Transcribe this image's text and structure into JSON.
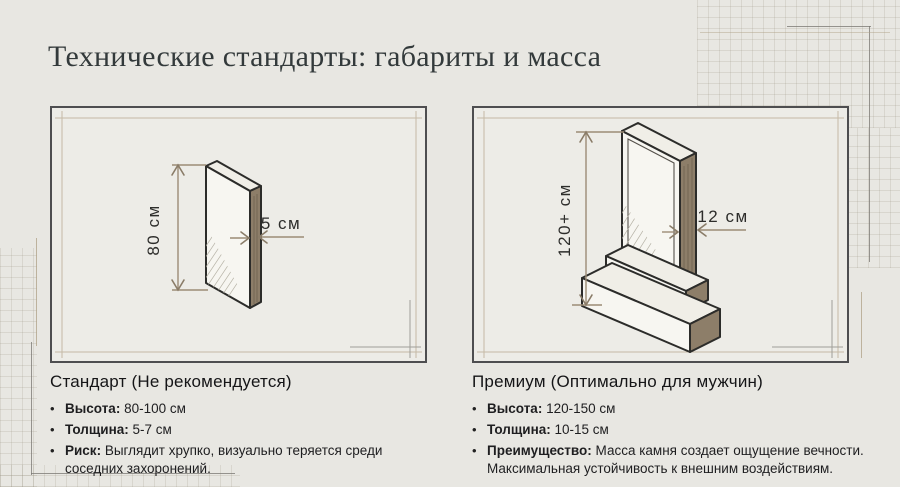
{
  "title": "Технические стандарты: габариты и масса",
  "bullet_icon": "•",
  "panels": [
    {
      "id": "standard",
      "heading": "Стандарт (Не рекомендуется)",
      "dimensions": {
        "height_label": "80 см",
        "thickness_label": "5 см"
      },
      "bullets": [
        {
          "label": "Высота:",
          "text": "80-100 см"
        },
        {
          "label": "Толщина:",
          "text": "5-7 см"
        },
        {
          "label": "Риск:",
          "text": "Выглядит хрупко, визуально теряется среди соседних захоронений."
        }
      ]
    },
    {
      "id": "premium",
      "heading": "Премиум (Оптимально для мужчин)",
      "dimensions": {
        "height_label": "120+ см",
        "thickness_label": "12 см"
      },
      "bullets": [
        {
          "label": "Высота:",
          "text": "120-150 см"
        },
        {
          "label": "Толщина:",
          "text": "10-15 см"
        },
        {
          "label": "Преимущество:",
          "text": "Масса камня создает ощущение вечности. Максимальная устойчивость к внешним воздействиям."
        }
      ]
    }
  ],
  "colors": {
    "background": "#e8e7e2",
    "panel_background": "#edece7",
    "panel_border": "#4e4e50",
    "stone_outline": "#2c2c2a",
    "stone_side": "#8d7e69",
    "dimension_line": "#9c8c76",
    "title_text": "#333a3b"
  }
}
